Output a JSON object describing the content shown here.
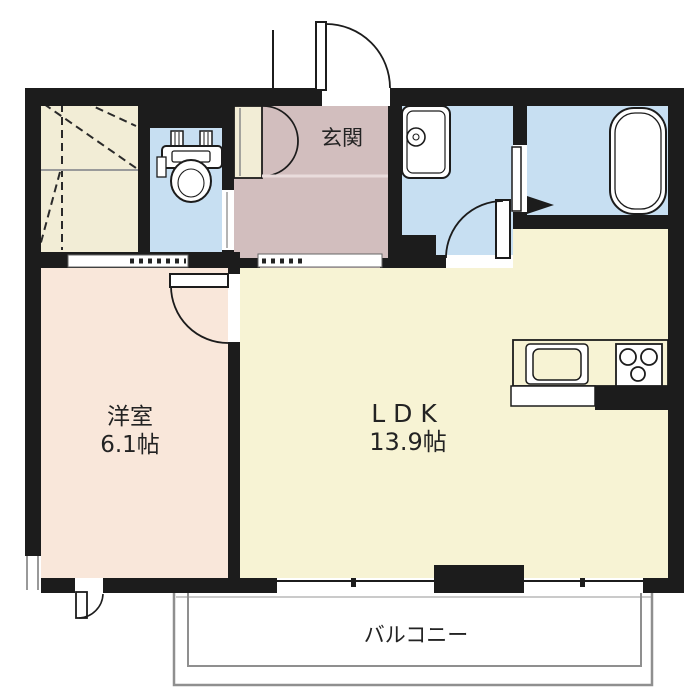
{
  "rooms": {
    "entrance": {
      "label": "玄関"
    },
    "western_room": {
      "label": "洋室",
      "size": "6.1帖"
    },
    "ldk": {
      "label": "LDK",
      "size": "13.9帖"
    },
    "balcony": {
      "label": "バルコニー"
    }
  },
  "colors": {
    "wall": "#1c1c1c",
    "floor_ldk": "#f7f3d4",
    "floor_bedroom": "#f9e7da",
    "floor_hall": "#d2bebe",
    "floor_wet": "#c7dff2",
    "floor_closet": "#f2edd6",
    "outline": "#8f8f8f",
    "label": "#232323"
  }
}
